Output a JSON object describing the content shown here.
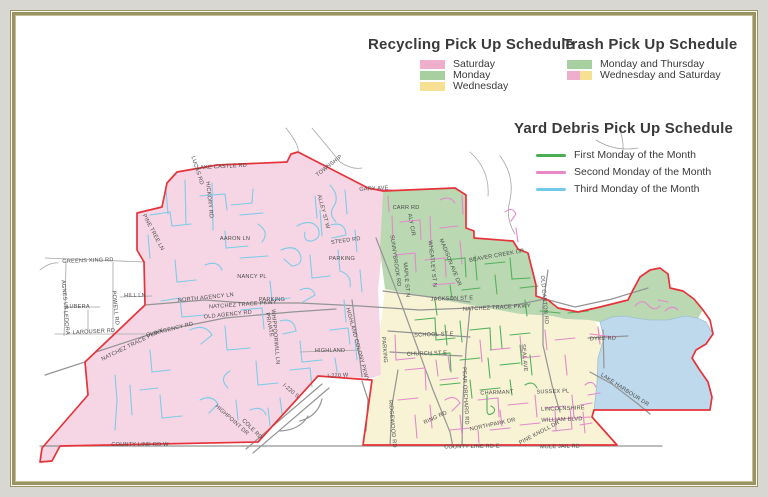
{
  "colors": {
    "outer_bg": "#d8d7d2",
    "frame_olive": "#9a9464",
    "boundary_red": "#e6333a",
    "region_pink": "#f6d6e4",
    "region_green": "#bad8b2",
    "region_yellow": "#f8f3d4",
    "lake_blue": "#bdd9eb",
    "legend_pink": "#efaecb",
    "legend_green": "#a8cf9f",
    "legend_yellow": "#f5e093",
    "line_first_monday": "#4cae52",
    "line_second_monday": "#e887c6",
    "line_third_monday": "#72cbe8",
    "street_blue": "#7ecbe8",
    "street_magenta": "#e389cd",
    "street_green": "#53b05e",
    "road_gray_minor": "#a5a5a5",
    "road_gray_major": "#949494",
    "label_text": "#4c4c4c"
  },
  "legends": {
    "recycling": {
      "title": "Recycling Pick Up Schedule",
      "items": [
        {
          "label": "Saturday",
          "swatch": "pink"
        },
        {
          "label": "Monday",
          "swatch": "green"
        },
        {
          "label": "Wednesday",
          "swatch": "yellow"
        }
      ]
    },
    "trash": {
      "title": "Trash Pick Up Schedule",
      "items": [
        {
          "label": "Monday and Thursday",
          "swatch": "green"
        },
        {
          "label": "Wednesday and Saturday",
          "swatch": "pink-yellow"
        }
      ]
    },
    "yard": {
      "title": "Yard Debris Pick Up Schedule",
      "items": [
        {
          "label": "First Monday of the Month",
          "line": "green"
        },
        {
          "label": "Second Monday of the Month",
          "line": "pink"
        },
        {
          "label": "Third Monday of the Month",
          "line": "blue"
        }
      ]
    }
  },
  "map": {
    "labels": [
      {
        "t": "TOWNSHIP",
        "x": 330,
        "y": 167,
        "r": -38
      },
      {
        "t": "LAKE CASTLE RD",
        "x": 222,
        "y": 168,
        "r": -3
      },
      {
        "t": "LUCAS RD",
        "x": 196,
        "y": 171,
        "r": 72
      },
      {
        "t": "HICKORY RD",
        "x": 208,
        "y": 200,
        "r": 84
      },
      {
        "t": "PINE TREE LN",
        "x": 152,
        "y": 233,
        "r": 62
      },
      {
        "t": "AARON LN",
        "x": 235,
        "y": 240,
        "r": 0
      },
      {
        "t": "NANCY PL",
        "x": 252,
        "y": 278,
        "r": 0
      },
      {
        "t": "GREENS XING RD",
        "x": 88,
        "y": 262,
        "r": -2
      },
      {
        "t": "AGNES LN",
        "x": 63,
        "y": 295,
        "r": 84
      },
      {
        "t": "HILL LN",
        "x": 135,
        "y": 297,
        "r": 0
      },
      {
        "t": "LUBERA",
        "x": 78,
        "y": 308,
        "r": 0
      },
      {
        "t": "LEDORA",
        "x": 65,
        "y": 323,
        "r": 84
      },
      {
        "t": "POWELL RD",
        "x": 114,
        "y": 308,
        "r": 84
      },
      {
        "t": "LAROUSER RD",
        "x": 94,
        "y": 333,
        "r": -3
      },
      {
        "t": "NATCHEZ TRACE PKWY",
        "x": 133,
        "y": 346,
        "r": -26
      },
      {
        "t": "OLD AGENCY RD",
        "x": 170,
        "y": 331,
        "r": -14
      },
      {
        "t": "NORTH AGENCY LN",
        "x": 206,
        "y": 299,
        "r": -6
      },
      {
        "t": "NATCHEZ TRACE PKWY",
        "x": 243,
        "y": 306,
        "r": -4
      },
      {
        "t": "OLD AGENCY RD",
        "x": 228,
        "y": 316,
        "r": -6
      },
      {
        "t": "WHIPPOORWILL LN",
        "x": 274,
        "y": 337,
        "r": 85
      },
      {
        "t": "HIGHLAND",
        "x": 330,
        "y": 352,
        "r": 0
      },
      {
        "t": "HIGHLAND COLONY PKWY",
        "x": 356,
        "y": 345,
        "r": 75
      },
      {
        "t": "I-220 W",
        "x": 338,
        "y": 377,
        "r": -3
      },
      {
        "t": "I-220 S",
        "x": 290,
        "y": 392,
        "r": 40
      },
      {
        "t": "HIGHPOINT DR",
        "x": 231,
        "y": 421,
        "r": 42
      },
      {
        "t": "COLE RD",
        "x": 251,
        "y": 430,
        "r": 45
      },
      {
        "t": "COUNTY LINE RD W",
        "x": 140,
        "y": 446,
        "r": 0
      },
      {
        "t": "ALLEY ST W",
        "x": 322,
        "y": 212,
        "r": 75
      },
      {
        "t": "STEED RD",
        "x": 346,
        "y": 242,
        "r": -8
      },
      {
        "t": "PARKING",
        "x": 342,
        "y": 260,
        "r": 0
      },
      {
        "t": "PARKING",
        "x": 272,
        "y": 301,
        "r": 0
      },
      {
        "t": "PARKING",
        "x": 383,
        "y": 350,
        "r": 85
      },
      {
        "t": "PRIVATE",
        "x": 268,
        "y": 325,
        "r": 80
      },
      {
        "t": "GARY AVE",
        "x": 374,
        "y": 190,
        "r": -3
      },
      {
        "t": "CARR RD",
        "x": 406,
        "y": 209,
        "r": 0
      },
      {
        "t": "ALY CIR",
        "x": 410,
        "y": 225,
        "r": 80
      },
      {
        "t": "SUNNYBROOK RD",
        "x": 394,
        "y": 261,
        "r": 82
      },
      {
        "t": "WHEATLEY ST N",
        "x": 431,
        "y": 264,
        "r": 84
      },
      {
        "t": "MADISON AVE DR",
        "x": 449,
        "y": 263,
        "r": 68
      },
      {
        "t": "BEAVER CREEK DR",
        "x": 497,
        "y": 257,
        "r": -10
      },
      {
        "t": "JACKSON ST E",
        "x": 452,
        "y": 300,
        "r": -2
      },
      {
        "t": "NATCHEZ TRACE PKWY",
        "x": 497,
        "y": 309,
        "r": -3
      },
      {
        "t": "OLD CANTON RD",
        "x": 543,
        "y": 300,
        "r": 85
      },
      {
        "t": "MAPLE ST N",
        "x": 405,
        "y": 280,
        "r": 85
      },
      {
        "t": "SCHOOL ST E",
        "x": 434,
        "y": 336,
        "r": -2
      },
      {
        "t": "CHURCH ST E",
        "x": 427,
        "y": 355,
        "r": -2
      },
      {
        "t": "PEAR ORCHARD RD",
        "x": 464,
        "y": 396,
        "r": 87
      },
      {
        "t": "RIDGEWOOD RD",
        "x": 391,
        "y": 424,
        "r": 85
      },
      {
        "t": "RING RD",
        "x": 436,
        "y": 419,
        "r": -25
      },
      {
        "t": "CHARMANT",
        "x": 497,
        "y": 394,
        "r": -2
      },
      {
        "t": "SUSSEX PL",
        "x": 553,
        "y": 393,
        "r": -2
      },
      {
        "t": "LINCOLNSHIRE",
        "x": 563,
        "y": 410,
        "r": -2
      },
      {
        "t": "WILLIAM BLVD",
        "x": 562,
        "y": 421,
        "r": -2
      },
      {
        "t": "PINE KNOLL DR",
        "x": 540,
        "y": 434,
        "r": -28
      },
      {
        "t": "NORTHPARK DR",
        "x": 493,
        "y": 426,
        "r": -12
      },
      {
        "t": "COUNTY LINE RD E",
        "x": 472,
        "y": 448,
        "r": -1
      },
      {
        "t": "MULE JAIL RD",
        "x": 560,
        "y": 448,
        "r": -1
      },
      {
        "t": "DYKE RD",
        "x": 603,
        "y": 340,
        "r": -2
      },
      {
        "t": "LAKE HARBOUR DR",
        "x": 624,
        "y": 391,
        "r": 33
      },
      {
        "t": "SEAL AVE",
        "x": 523,
        "y": 358,
        "r": 85
      }
    ]
  }
}
